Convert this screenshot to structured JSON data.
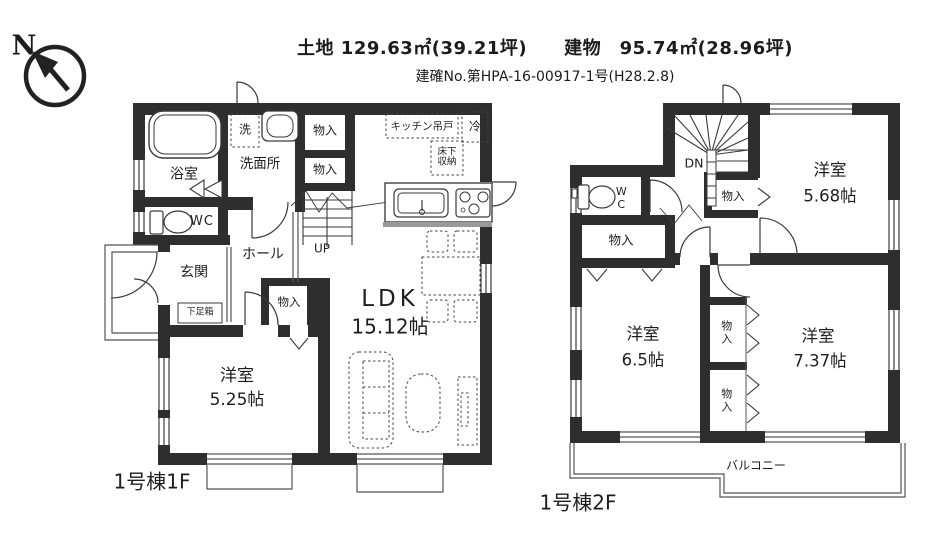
{
  "header": {
    "line1": "土地 129.63㎡(39.21坪)　　建物　95.74㎡(28.96坪)",
    "line2": "建確No.第HPA-16-00917-1号(H28.2.8)"
  },
  "compass": {
    "north_label": "N"
  },
  "floor1": {
    "floor_label": "1号棟1F",
    "rooms": {
      "bath": "浴室",
      "washer": "洗",
      "washroom": "洗面所",
      "storage_top_1": "物入",
      "storage_top_2": "物入",
      "wc": "WC",
      "hall": "ホール",
      "stairs_up": "UP",
      "entrance": "玄関",
      "shoe_box": "下足箱",
      "storage_hall": "物入",
      "bedroom_name": "洋室",
      "bedroom_size": "5.25帖",
      "ldk_name": "LDK",
      "ldk_size": "15.12帖",
      "kitchen_cabinet": "キッチン吊戸",
      "fridge": "冷",
      "underfloor_storage": "床下収納"
    }
  },
  "floor2": {
    "floor_label": "1号棟2F",
    "rooms": {
      "stairs_down": "DN",
      "wc": "WC",
      "storage_stairs": "物入",
      "storage_left": "物入",
      "room_a_name": "洋室",
      "room_a_size": "5.68帖",
      "room_b_name": "洋室",
      "room_b_size": "6.5帖",
      "room_c_name": "洋室",
      "room_c_size": "7.37帖",
      "storage_mid_1": "物入",
      "storage_mid_2": "物入",
      "balcony": "バルコニー"
    }
  }
}
